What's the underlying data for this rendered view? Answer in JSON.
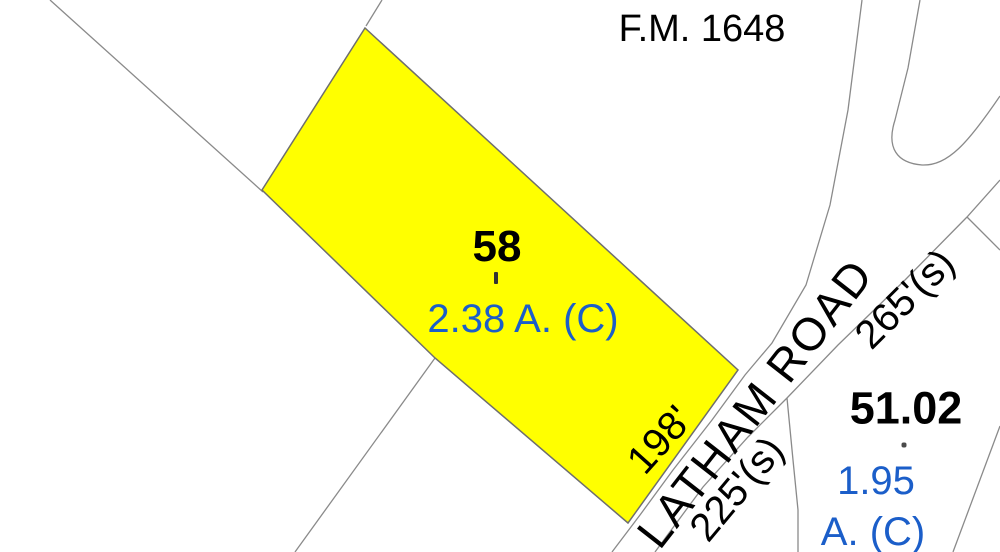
{
  "map": {
    "road_labels": {
      "fm": "F.M. 1648",
      "latham": "LATHAM ROAD"
    },
    "parcels": [
      {
        "id": "58",
        "acreage": "2.38 A. (C)",
        "highlighted": true
      },
      {
        "id": "51.02",
        "acreage_line1": "1.95",
        "acreage_line2": "A. (C)",
        "highlighted": false
      }
    ],
    "dimensions": [
      "198'",
      "225'(s)",
      "265'(s)"
    ],
    "colors": {
      "background": "#ffffff",
      "highlight_fill": "#ffff00",
      "highlight_stroke": "#6e6e6e",
      "boundary_line": "#8a8a8a",
      "label_text": "#000000",
      "acreage_text": "#1b5ec9"
    }
  }
}
